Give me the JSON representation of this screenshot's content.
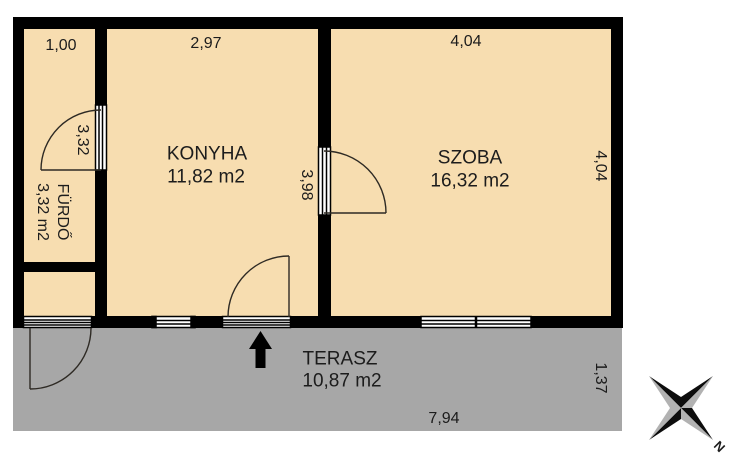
{
  "floor_plan": {
    "rooms": {
      "konyha": {
        "label": "KONYHA",
        "area": "11,82 m2"
      },
      "szoba": {
        "label": "SZOBA",
        "area": "16,32 m2"
      },
      "furdo": {
        "label": "FÜRDŐ",
        "area": "3,32 m2"
      },
      "terasz": {
        "label": "TERASZ",
        "area": "10,87 m2"
      }
    },
    "dimensions": {
      "furdo_width": "1,00",
      "konyha_width": "2,97",
      "szoba_width": "4,04",
      "furdo_height": "3,32",
      "konyha_height": "3,98",
      "szoba_height": "4,04",
      "terasz_height": "1,37",
      "terasz_width": "7,94"
    },
    "compass": {
      "north_label": "N"
    },
    "colors": {
      "room": "#f7ddb0",
      "terrace": "#a7a7a7",
      "wall": "#000000",
      "line": "#2e2a24",
      "compass_dark": "#0d0d0d",
      "compass_light": "#b2b2b2"
    }
  }
}
